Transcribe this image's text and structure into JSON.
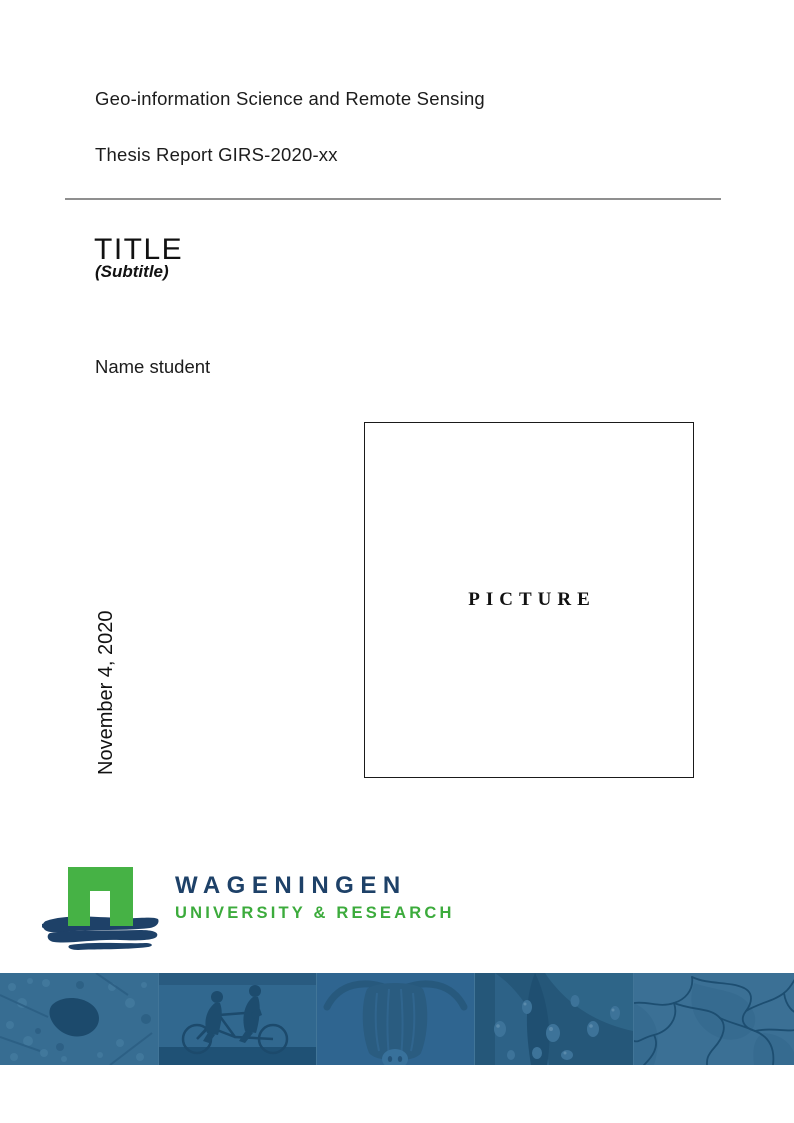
{
  "document": {
    "program": "Geo-information Science and Remote Sensing",
    "report_id": "Thesis Report GIRS-2020-xx",
    "title": "TITLE",
    "subtitle": "(Subtitle)",
    "author": "Name student",
    "date": "November 4, 2020",
    "picture_placeholder": "PICTURE"
  },
  "logo": {
    "institution": "WAGENINGEN",
    "tagline": "UNIVERSITY & RESEARCH",
    "colors": {
      "green": "#3fb03a",
      "navy": "#1e4168"
    }
  },
  "banner": {
    "tint_color": "#336a8e",
    "photos": [
      "aerial-map",
      "tandem-cyclists",
      "highland-cow",
      "water-droplets",
      "cracked-earth"
    ]
  }
}
